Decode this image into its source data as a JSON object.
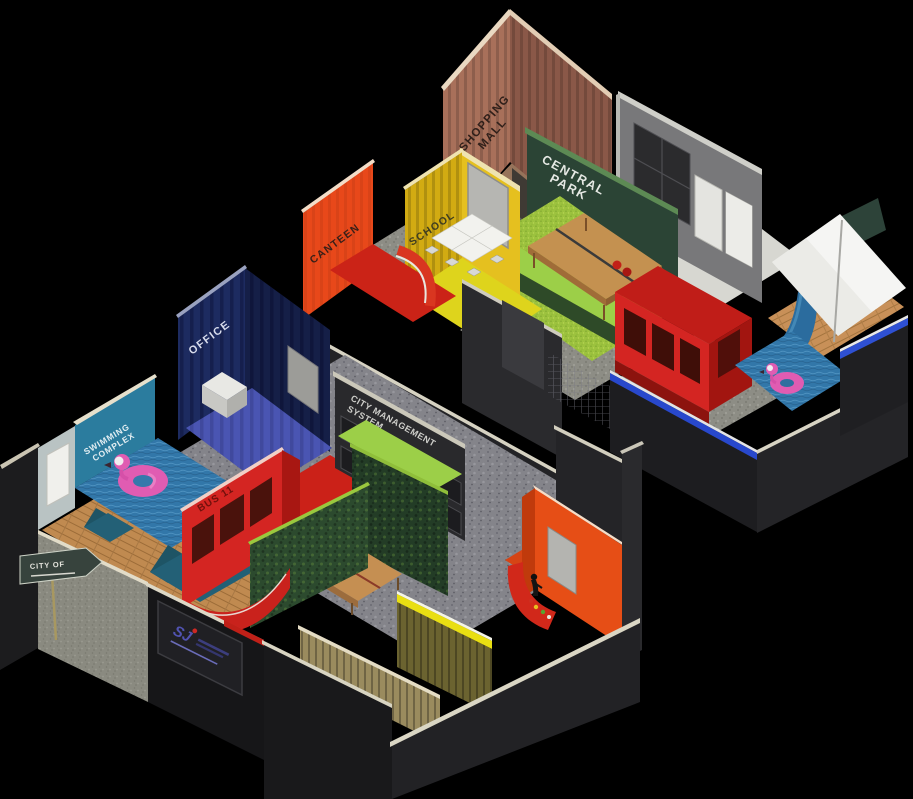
{
  "scene": {
    "background": "#000000",
    "description": "Isometric 3D floor plan of a city-themed office with two floor plates",
    "floors": {
      "upper": {
        "rooms": [
          "SHOPPING MALL",
          "CENTRAL PARK",
          "SCHOOL",
          "CANTEEN"
        ]
      },
      "lower": {
        "rooms": [
          "OFFICE",
          "SWIMMING COMPLEX",
          "CITY MANAGEMENT SYSTEM",
          "BUS 11"
        ]
      }
    },
    "labels": {
      "shopping_1": "SHOPPING",
      "shopping_2": "MALL",
      "central_1": "CENTRAL",
      "central_2": "PARK",
      "canteen": "CANTEEN",
      "school": "SCHOOL",
      "office": "OFFICE",
      "cms_1": "CITY MANAGEMENT",
      "cms_2": "SYSTEM",
      "swim_1": "SWIMMING",
      "swim_2": "COMPLEX",
      "bus": "BUS 11",
      "city_sign": "CITY OF",
      "logo": "SJ"
    },
    "colors": {
      "mall_left": "#a8705a",
      "mall_right": "#8a5848",
      "park_wall": "#2b4435",
      "canteen_wall": "#e8481a",
      "school_left": "#d2ab12",
      "school_right": "#e5c01f",
      "office_left": "#1d2b60",
      "office_right": "#151f47",
      "swim_wall": "#2b7c9e",
      "bus_red": "#d42522",
      "cms_wall": "#29292c",
      "orange_room": "#e64e16",
      "grass": "#9cc23e",
      "water": "#3277a9",
      "flamingo": "#e05cb2",
      "wood": "#c08a50",
      "trim_blue": "#2848cc",
      "trim_yellow": "#e9df12",
      "dark_wall": "#232326",
      "stone_floor": "#8d8d85"
    }
  }
}
